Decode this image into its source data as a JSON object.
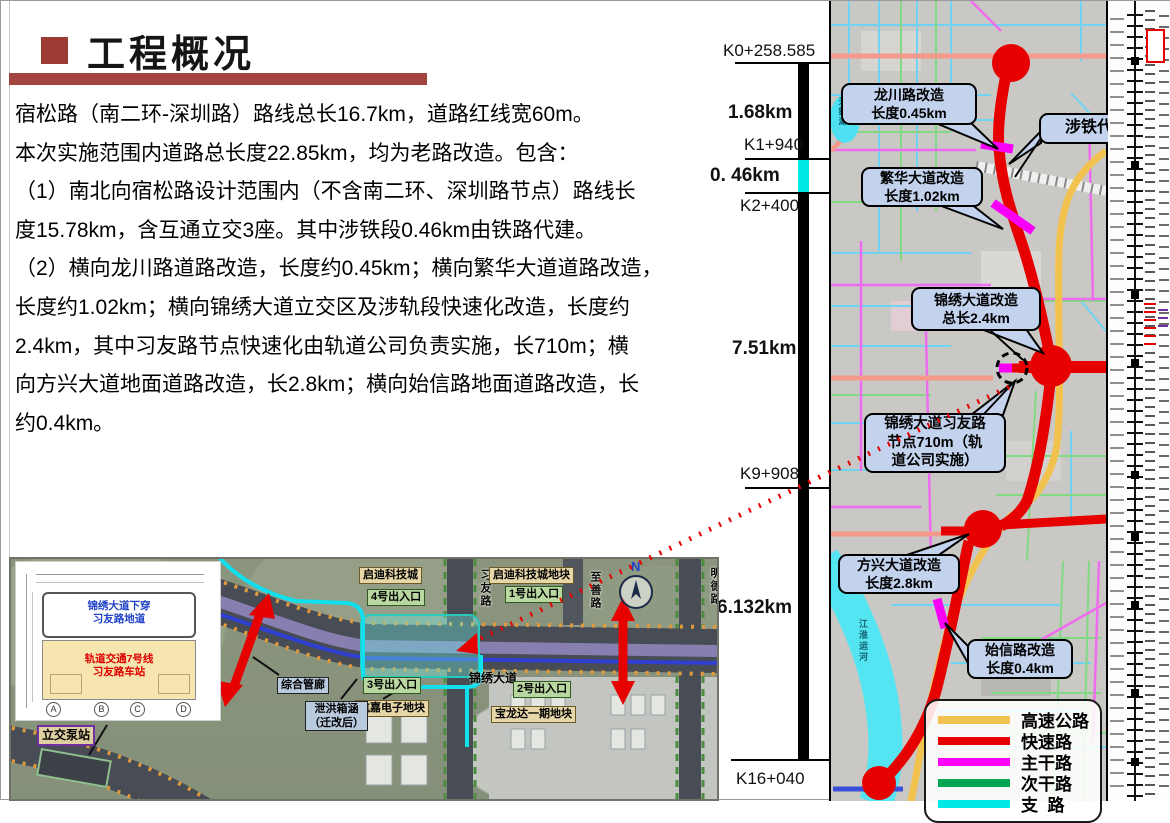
{
  "slide": {
    "title": "工程概况",
    "body_lines": [
      "宿松路（南二环-深圳路）路线总长16.7km，道路红线宽60m。",
      "本次实施范围内道路总长度22.85km，均为老路改造。包含：",
      "（1）南北向宿松路设计范围内（不含南二环、深圳路节点）路线长",
      "度15.78km，含互通立交3座。其中涉铁段0.46km由铁路代建。",
      "（2）横向龙川路道路改造，长度约0.45km；横向繁华大道道路改造，",
      "长度约1.02km；横向锦绣大道立交区及涉轨段快速化改造，长度约",
      "2.4km，其中习友路节点快速化由轨道公司负责实施，长710m；横",
      "向方兴大道地面道路改造，长2.8km；横向始信路地面道路改造，长",
      "约0.4km。"
    ]
  },
  "chainage": {
    "k0": "K0+258.585",
    "seg1": "1.68km",
    "k1": "K1+940",
    "seg2": "0. 46km",
    "k2": "K2+400",
    "seg3": "7.51km",
    "k3": "K9+908",
    "seg4": "6.132km",
    "k4": "K16+040"
  },
  "map": {
    "callouts": {
      "longchuan1": "龙川路改造",
      "longchuan2": "长度0.45km",
      "sheti": "涉铁代建段",
      "fanhua1": "繁华大道改造",
      "fanhua2": "长度1.02km",
      "jinxiu1": "锦绣大道改造",
      "jinxiu2": "总长2.4km",
      "node1": "锦绣大道习友路",
      "node2": "节点710m（轨",
      "node3": "道公司实施）",
      "fangxing1": "方兴大道改造",
      "fangxing2": "长度2.8km",
      "shixin1": "始信路改造",
      "shixin2": "长度0.4km"
    },
    "water": {
      "lake": "天鹅湖",
      "canal": "江淮运河"
    },
    "legend": [
      {
        "label": "高速公路",
        "color": "#f2c24e"
      },
      {
        "label": "快速路",
        "color": "#e60000"
      },
      {
        "label": "主干路",
        "color": "#ff00ff"
      },
      {
        "label": "次干路",
        "color": "#00a651"
      },
      {
        "label": "支  路",
        "color": "#00e8e8"
      }
    ]
  },
  "inset": {
    "labels": {
      "qidi": "启迪科技城",
      "qidi_block": "启迪科技城地块",
      "exit1": "1号出入口",
      "exit2": "2号出入口",
      "exit3": "3号出入口",
      "exit4": "4号出入口",
      "xiyou": "习友路",
      "zhishan": "至善路",
      "mingde": "明德路",
      "jinxiu": "锦绣大道",
      "hangjia": "航嘉电子地块",
      "baolongda": "宝龙达一期地块",
      "guanlang": "综合管廊",
      "xiehong1": "泄洪箱涵",
      "xiehong2": "（迁改后）",
      "pump": "立交泵站",
      "compass": "N"
    },
    "drawing": {
      "blue1": "锦绣大道下穿",
      "blue2": "习友路地道",
      "red1": "轨道交通7号线",
      "red2": "习友路车站",
      "col1": "A",
      "col2": "B",
      "col3": "C",
      "col4": "D"
    }
  },
  "colors": {
    "accent_red": "#9d3b35",
    "route_red": "#e60000",
    "highway_yellow": "#f2c24e",
    "arterial_magenta": "#ff00ff",
    "secondary_green": "#00a651",
    "branch_cyan": "#00e8e8",
    "callout_bg": "#c3d3ee"
  }
}
